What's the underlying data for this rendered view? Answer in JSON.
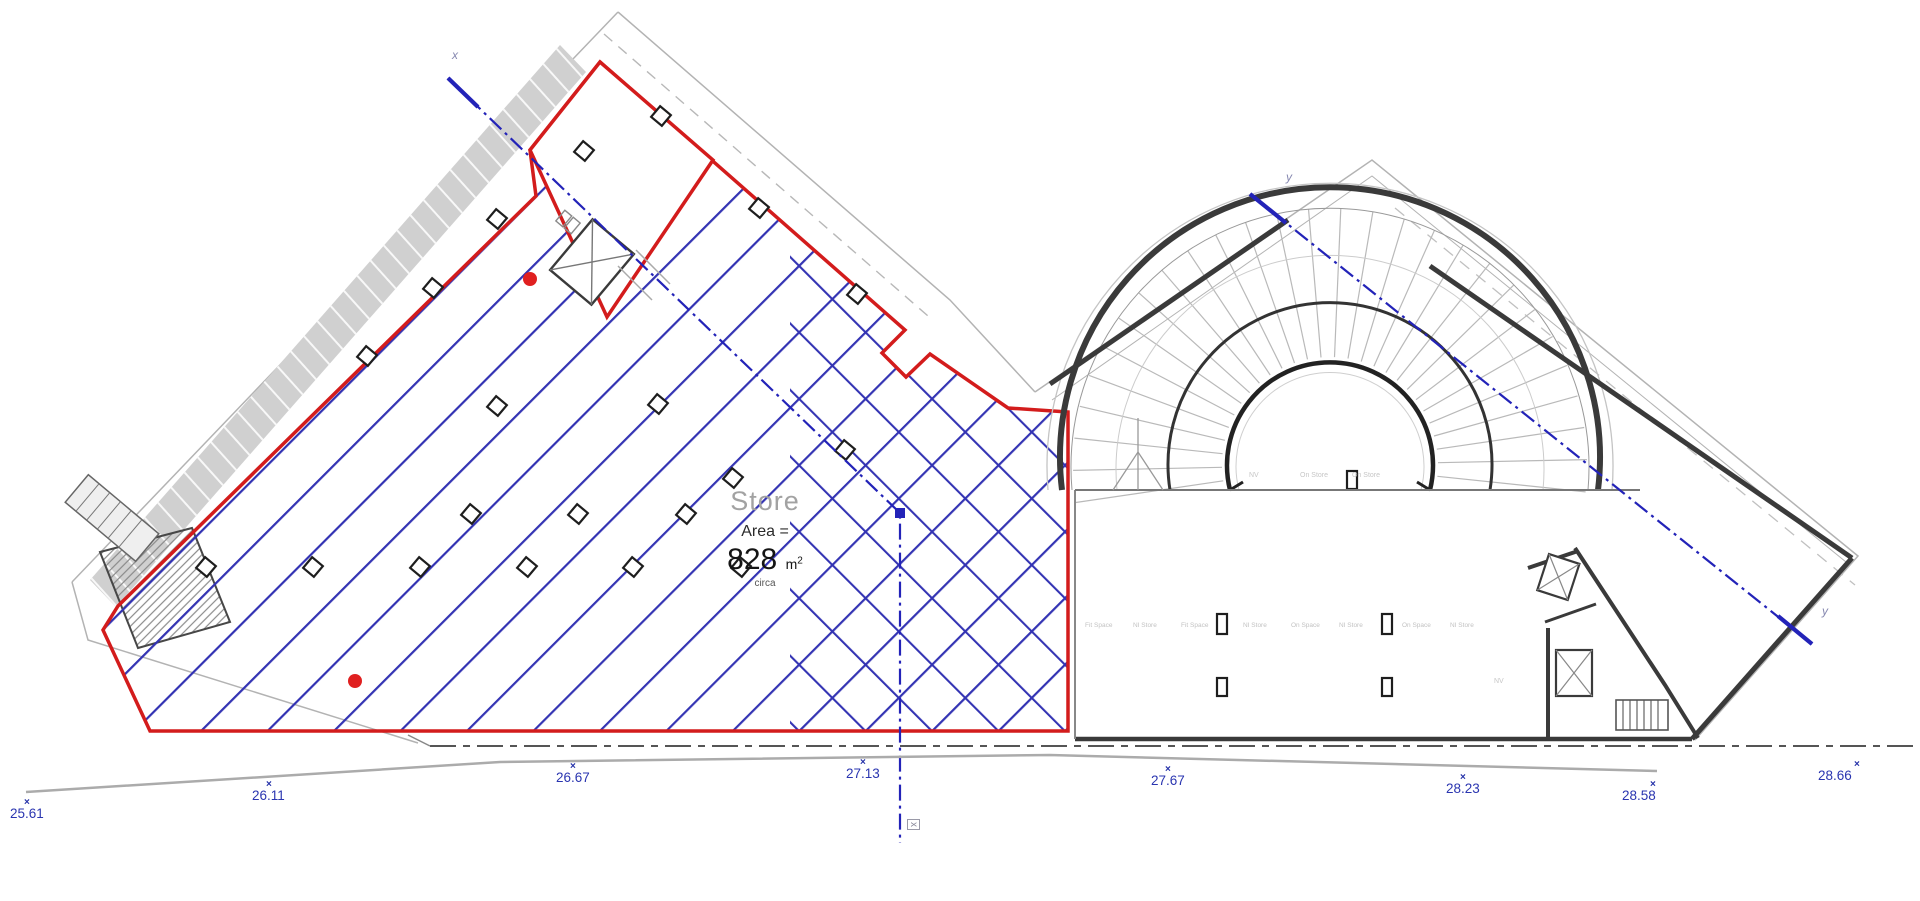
{
  "plan": {
    "room_label": "Store",
    "area_label": "Area =",
    "area_value": "828",
    "area_unit": "m",
    "area_exponent": "2",
    "area_note": "circa"
  },
  "levels": [
    {
      "value": "25.61"
    },
    {
      "value": "26.11"
    },
    {
      "value": "26.67"
    },
    {
      "value": "27.13"
    },
    {
      "value": "27.67"
    },
    {
      "value": "28.23"
    },
    {
      "value": "28.58"
    },
    {
      "value": "28.66"
    }
  ],
  "section_markers": {
    "x_start": "x",
    "x_end": "x",
    "y_start": "y",
    "y_end": "y"
  },
  "small_labels": {
    "upper": [
      "NV",
      "On Store",
      "On Store"
    ],
    "row": [
      "Fit Space",
      "NI Store",
      "Fit Space",
      "NI Store",
      "On Space",
      "NI Store",
      "On Space",
      "NI Store"
    ],
    "corner": "NV"
  },
  "colors": {
    "boundary_red": "#d31c1c",
    "hatch_blue": "#3333b3",
    "section_blue": "#2323b8",
    "level_blue": "#2a35b0",
    "wall_dark": "#3a3a3a",
    "ramp_gray": "#d0d0d0"
  }
}
